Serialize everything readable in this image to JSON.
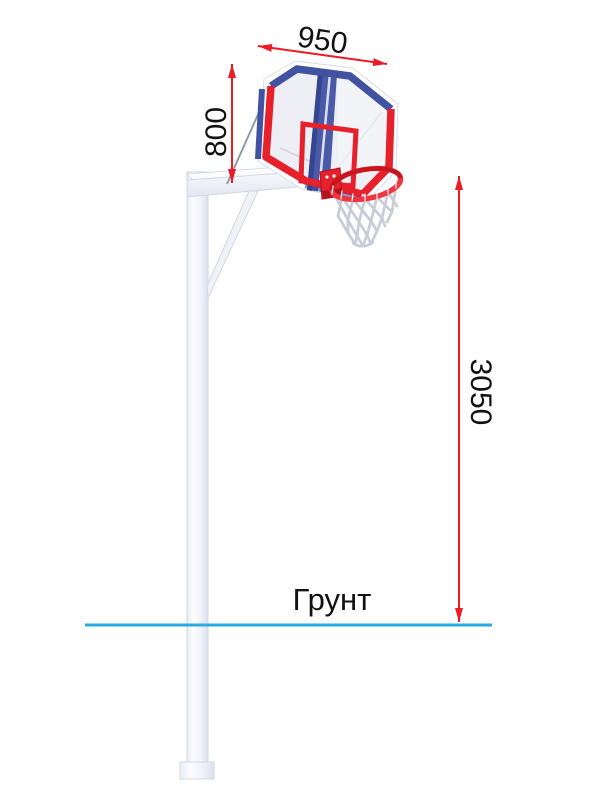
{
  "figure": {
    "dimensions": {
      "backboard_width": "950",
      "backboard_height": "800",
      "rim_height": "3050"
    },
    "ground_label": "Грунт",
    "colors": {
      "dimension_red": "#ec1b26",
      "frame_red": "#e8202c",
      "frame_blue": "#4152a0",
      "frame_blue_dark": "#35458f",
      "ground_blue": "#29abe2",
      "steel_edge": "#d2d6e1",
      "cable_gray": "#939aa7",
      "net_gray": "#c9cdd7",
      "text_black": "#111111"
    }
  }
}
